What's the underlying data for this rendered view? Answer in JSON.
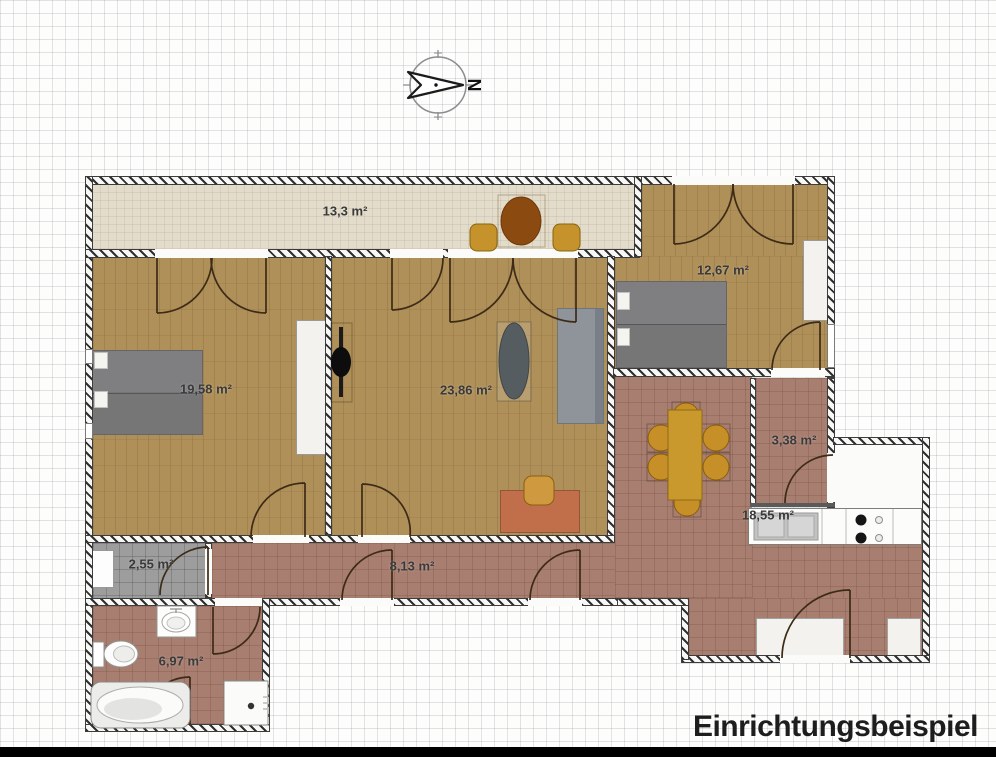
{
  "caption": "Einrichtungsbeispiel",
  "compass": {
    "letter": "N"
  },
  "rooms": {
    "balcony": {
      "name": "balcony",
      "area": "13,3 m²"
    },
    "bedroom_left": {
      "name": "bedroom-left",
      "area": "19,58 m²"
    },
    "living": {
      "name": "living-room",
      "area": "23,86 m²"
    },
    "bedroom_right": {
      "name": "bedroom-right",
      "area": "12,67 m²"
    },
    "dining": {
      "name": "dining-kitchen",
      "area": "18,55 m²"
    },
    "small_room": {
      "name": "small-room",
      "area": "3,38 m²"
    },
    "hallway": {
      "name": "hallway",
      "area": "8,13 m²"
    },
    "utility": {
      "name": "utility-room",
      "area": "2,55 m²"
    },
    "bathroom": {
      "name": "bathroom",
      "area": "6,97 m²"
    }
  },
  "colors": {
    "wood_floor": "#b09059",
    "tile_floor": "#a87e70",
    "balcony_floor": "#e3dcca",
    "gray_floor": "#9d9d9d",
    "furniture_gray": "#7f7f81",
    "furniture_gold": "#c9992e",
    "furniture_terracotta": "#c06f4a",
    "table_brown": "#8a4a10"
  }
}
